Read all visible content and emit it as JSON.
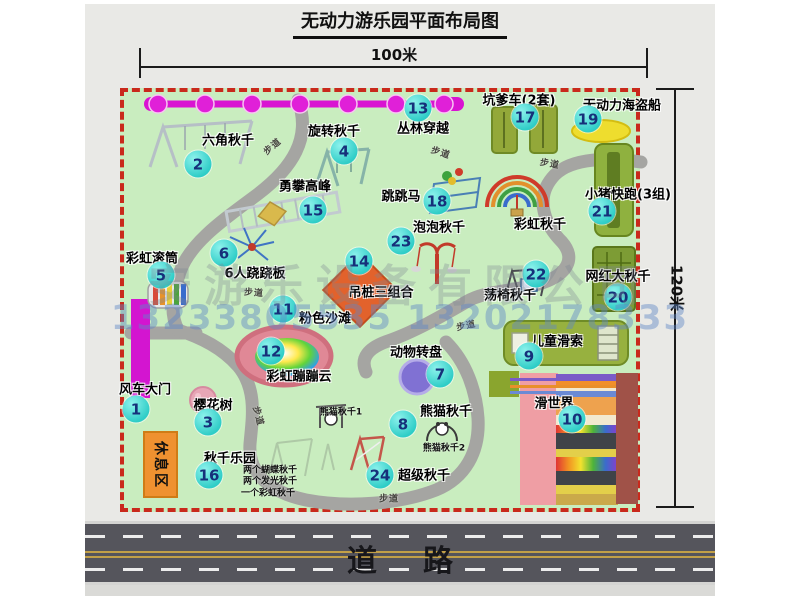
{
  "title": "无动力游乐园平面布局图",
  "scale": {
    "top": "100米",
    "right": "120米"
  },
  "road_label": "道路",
  "rest_area_label": "休息区",
  "watermark": {
    "company": "安游乐设备有限公司",
    "phone": "13233805535 13202178333"
  },
  "path_label_text": "步道",
  "colors": {
    "map_green": "#c9edbf",
    "border_red": "#c9291c",
    "badge_cyan": "#2fcdc7",
    "badge_text": "#16307a",
    "path_gray": "#a5a5a2",
    "zipline_magenta": "#d913d2",
    "gate_magenta": "#d315d0",
    "rest_area_orange": "#ef9130",
    "road_gray": "#55555c"
  },
  "facilities": [
    {
      "num": "1",
      "name": "风车大门",
      "label": [
        145,
        388
      ],
      "badge": [
        136,
        409
      ]
    },
    {
      "num": "2",
      "name": "六角秋千",
      "label": [
        228,
        139
      ],
      "badge": [
        198,
        164
      ]
    },
    {
      "num": "3",
      "name": "樱花树",
      "label": [
        213,
        404
      ],
      "badge": [
        208,
        422
      ]
    },
    {
      "num": "4",
      "name": "旋转秋千",
      "label": [
        334,
        130
      ],
      "badge": [
        344,
        151
      ]
    },
    {
      "num": "5",
      "name": "彩虹滚筒",
      "label": [
        152,
        257
      ],
      "badge": [
        161,
        275
      ]
    },
    {
      "num": "6",
      "name": "6人跷跷板",
      "label": [
        255,
        272
      ],
      "badge": [
        224,
        253
      ]
    },
    {
      "num": "7",
      "name": "动物转盘",
      "label": [
        416,
        351
      ],
      "badge": [
        440,
        374
      ]
    },
    {
      "num": "8",
      "name": "熊猫秋千",
      "label": [
        446,
        410
      ],
      "badge": [
        403,
        424
      ],
      "subs": [
        {
          "text": "熊猫秋千1",
          "pos": [
            341,
            411
          ]
        },
        {
          "text": "熊猫秋千2",
          "pos": [
            444,
            447
          ]
        }
      ]
    },
    {
      "num": "9",
      "name": "儿童滑索",
      "label": [
        557,
        340
      ],
      "badge": [
        529,
        356
      ]
    },
    {
      "num": "10",
      "name": "滑世界",
      "label": [
        554,
        402
      ],
      "badge": [
        572,
        419
      ]
    },
    {
      "num": "11",
      "name": "粉色沙滩",
      "label": [
        325,
        317
      ],
      "badge": [
        283,
        309
      ]
    },
    {
      "num": "12",
      "name": "彩虹蹦蹦云",
      "label": [
        299,
        375
      ],
      "badge": [
        271,
        351
      ]
    },
    {
      "num": "13",
      "name": "丛林穿越",
      "label": [
        423,
        127
      ],
      "badge": [
        418,
        108
      ]
    },
    {
      "num": "14",
      "name": "吊桩三组合",
      "label": [
        381,
        291
      ],
      "badge": [
        359,
        261
      ]
    },
    {
      "num": "15",
      "name": "勇攀高峰",
      "label": [
        305,
        185
      ],
      "badge": [
        313,
        210
      ]
    },
    {
      "num": "16",
      "name": "秋千乐园",
      "label": [
        230,
        457
      ],
      "badge": [
        209,
        475
      ],
      "subs": [
        {
          "text": "两个蝴蝶秋千",
          "pos": [
            270,
            469
          ]
        },
        {
          "text": "两个发光秋千",
          "pos": [
            270,
            480
          ]
        },
        {
          "text": "一个彩虹秋千",
          "pos": [
            268,
            492
          ]
        }
      ]
    },
    {
      "num": "17",
      "name": "坑爹车(2套)",
      "label": [
        519,
        99
      ],
      "badge": [
        525,
        117
      ]
    },
    {
      "num": "18",
      "name": "跳跳马",
      "label": [
        401,
        195
      ],
      "badge": [
        437,
        201
      ]
    },
    {
      "num": "19",
      "name": "无动力海盗船",
      "label": [
        622,
        104
      ],
      "badge": [
        588,
        119
      ]
    },
    {
      "num": "20",
      "name": "网红大秋千",
      "label": [
        618,
        275
      ],
      "badge": [
        618,
        297
      ]
    },
    {
      "num": "21",
      "name": "小猪快跑(3组)",
      "label": [
        628,
        193
      ],
      "badge": [
        602,
        211
      ]
    },
    {
      "num": "22",
      "name": "荡椅秋千",
      "label": [
        510,
        294
      ],
      "badge": [
        536,
        274
      ]
    },
    {
      "num": "23",
      "name": "泡泡秋千",
      "label": [
        439,
        226
      ],
      "badge": [
        401,
        241
      ]
    },
    {
      "num": "24",
      "name": "超级秋千",
      "label": [
        424,
        474
      ],
      "badge": [
        380,
        475
      ]
    },
    {
      "num": "",
      "name": "彩虹秋千",
      "label": [
        540,
        223
      ]
    }
  ],
  "path_labels": [
    {
      "pos": [
        272,
        146
      ],
      "rot": -40
    },
    {
      "pos": [
        441,
        152
      ],
      "rot": 18
    },
    {
      "pos": [
        550,
        163
      ],
      "rot": 10
    },
    {
      "pos": [
        254,
        292
      ],
      "rot": 4
    },
    {
      "pos": [
        259,
        416
      ],
      "rot": 75
    },
    {
      "pos": [
        389,
        498
      ],
      "rot": 0
    },
    {
      "pos": [
        466,
        325
      ],
      "rot": -12
    }
  ]
}
